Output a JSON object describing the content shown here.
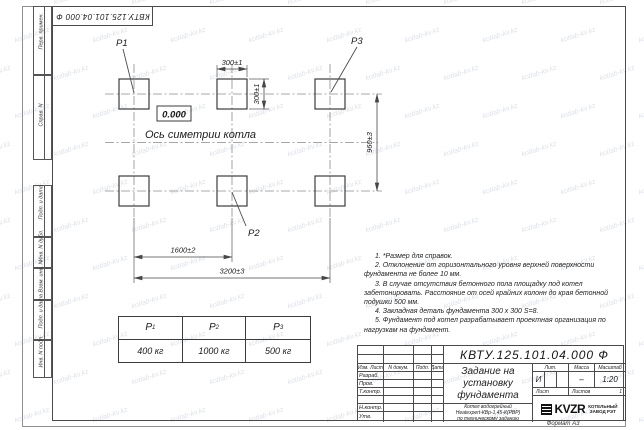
{
  "watermark": "kotlab-kv.kz",
  "corner_stamp": "КВТУ.125.101.04.000  Ф",
  "margin_columns": [
    "Перв. примен.",
    "Справ. N",
    "Подп. и дата",
    "Инв. N дубл.",
    "Взам. инв. N",
    "Подп. и дата",
    "Инв. N подл."
  ],
  "drawing": {
    "point_labels": {
      "p1": "P1",
      "p2": "P2",
      "p3": "P3"
    },
    "level_mark": "0.000",
    "axis_caption": "Ось симетрии котла",
    "dims": {
      "width_top": "300±1",
      "height_side": "300±1",
      "vertical": "960±3",
      "mid": "1600±2",
      "total": "3200±3"
    }
  },
  "notes": [
    "1. *Размер для справок.",
    "2. Отклонение от горизонтального уровня верхней поверхности фундамента не более 10 мм.",
    "3. В случае отсутствия бетонного пола площадку под котел забетонировать. Расстояние от осей крайних колонн до края бетонной подушки 500 мм.",
    "4. Закладная деталь фундамента 300 x 300 S=8.",
    "5. Фундамент под котел разрабатывает проектная организация по нагрузкам на фундамент."
  ],
  "load_table": {
    "cols": [
      {
        "sym": "P",
        "sub": "1",
        "value": "400 кг"
      },
      {
        "sym": "P",
        "sub": "2",
        "value": "1000 кг"
      },
      {
        "sym": "P",
        "sub": "3",
        "value": "500 кг"
      }
    ]
  },
  "title_block": {
    "designation": "КВТУ.125.101.04.000  Ф",
    "doc_title": "Задание на установку фундамента",
    "doc_subtitle": [
      "Котел водогрейный",
      "Heatexpert-КВр-1,45-К(РВР)",
      "по техническому заданию"
    ],
    "header_cols": [
      "Изм. Лист",
      "N докум.",
      "Подп.",
      "Дата"
    ],
    "role_rows": [
      "Разраб.",
      "Пров.",
      "Т.контр.",
      "",
      "Н.контр.",
      "Утв."
    ],
    "lit_label": "Лит.",
    "mass_label": "Масса",
    "scale_label": "Масштаб",
    "lit_value": "И",
    "mass_value": "–",
    "scale_value": "1:20",
    "sheet_label": "Лист",
    "sheets_label": "Листов",
    "sheets_value": "1",
    "logo_text": "KVZR",
    "logo_caption": [
      "КОТЕЛЬНЫЙ",
      "ЗАВОД РЭТ"
    ],
    "format_note": "Формат А3"
  }
}
